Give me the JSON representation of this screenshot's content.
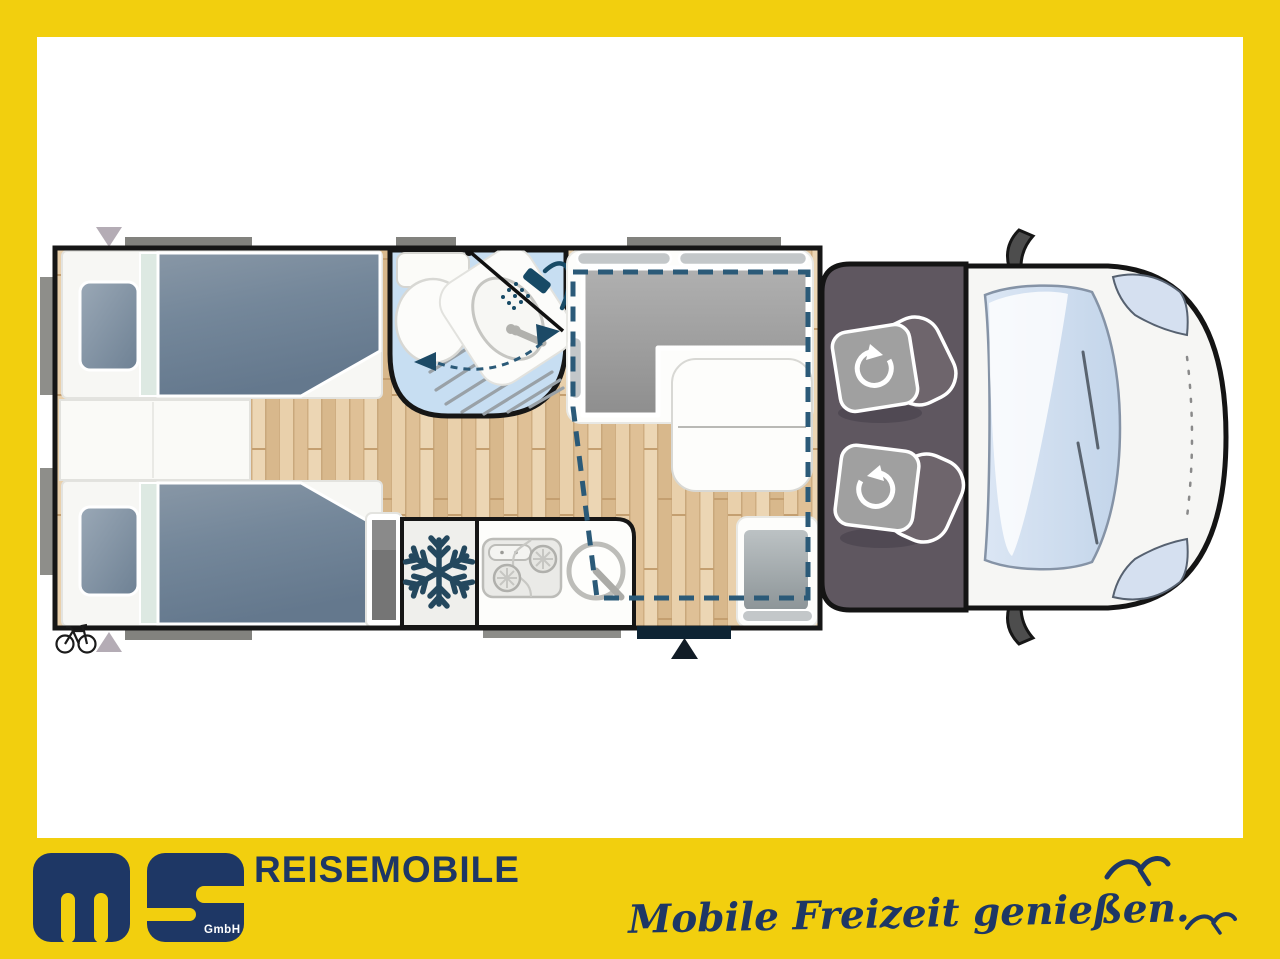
{
  "brand": {
    "logo_text": "ms",
    "gmbh": "GmbH",
    "name": "REISEMOBILE",
    "slogan": "Mobile Freizeit genießen."
  },
  "colors": {
    "frame_yellow": "#f2cf0e",
    "brand_navy": "#1e3765",
    "wall_black": "#161616",
    "wood_floor": "#e5c9a2",
    "bathroom_blue": "#c7def2",
    "duvet_blue_gray": "#74879a",
    "sofa_gray": "#9e9e9e",
    "cab_dark": "#5f5760",
    "windshield_blue": "#cddcee",
    "entry_door_navy": "#0e2434",
    "dashed_outline": "#2b5a78"
  },
  "icons": {
    "fridge": "snowflake-icon",
    "shower": "shower-head-icon",
    "swivel_seat": "rotate-arrow-icon",
    "rear_garage": "bicycle-icon",
    "entry": "triangle-up-icon",
    "front_marker": "triangle-down-icon",
    "birds": "seagull-icon"
  }
}
